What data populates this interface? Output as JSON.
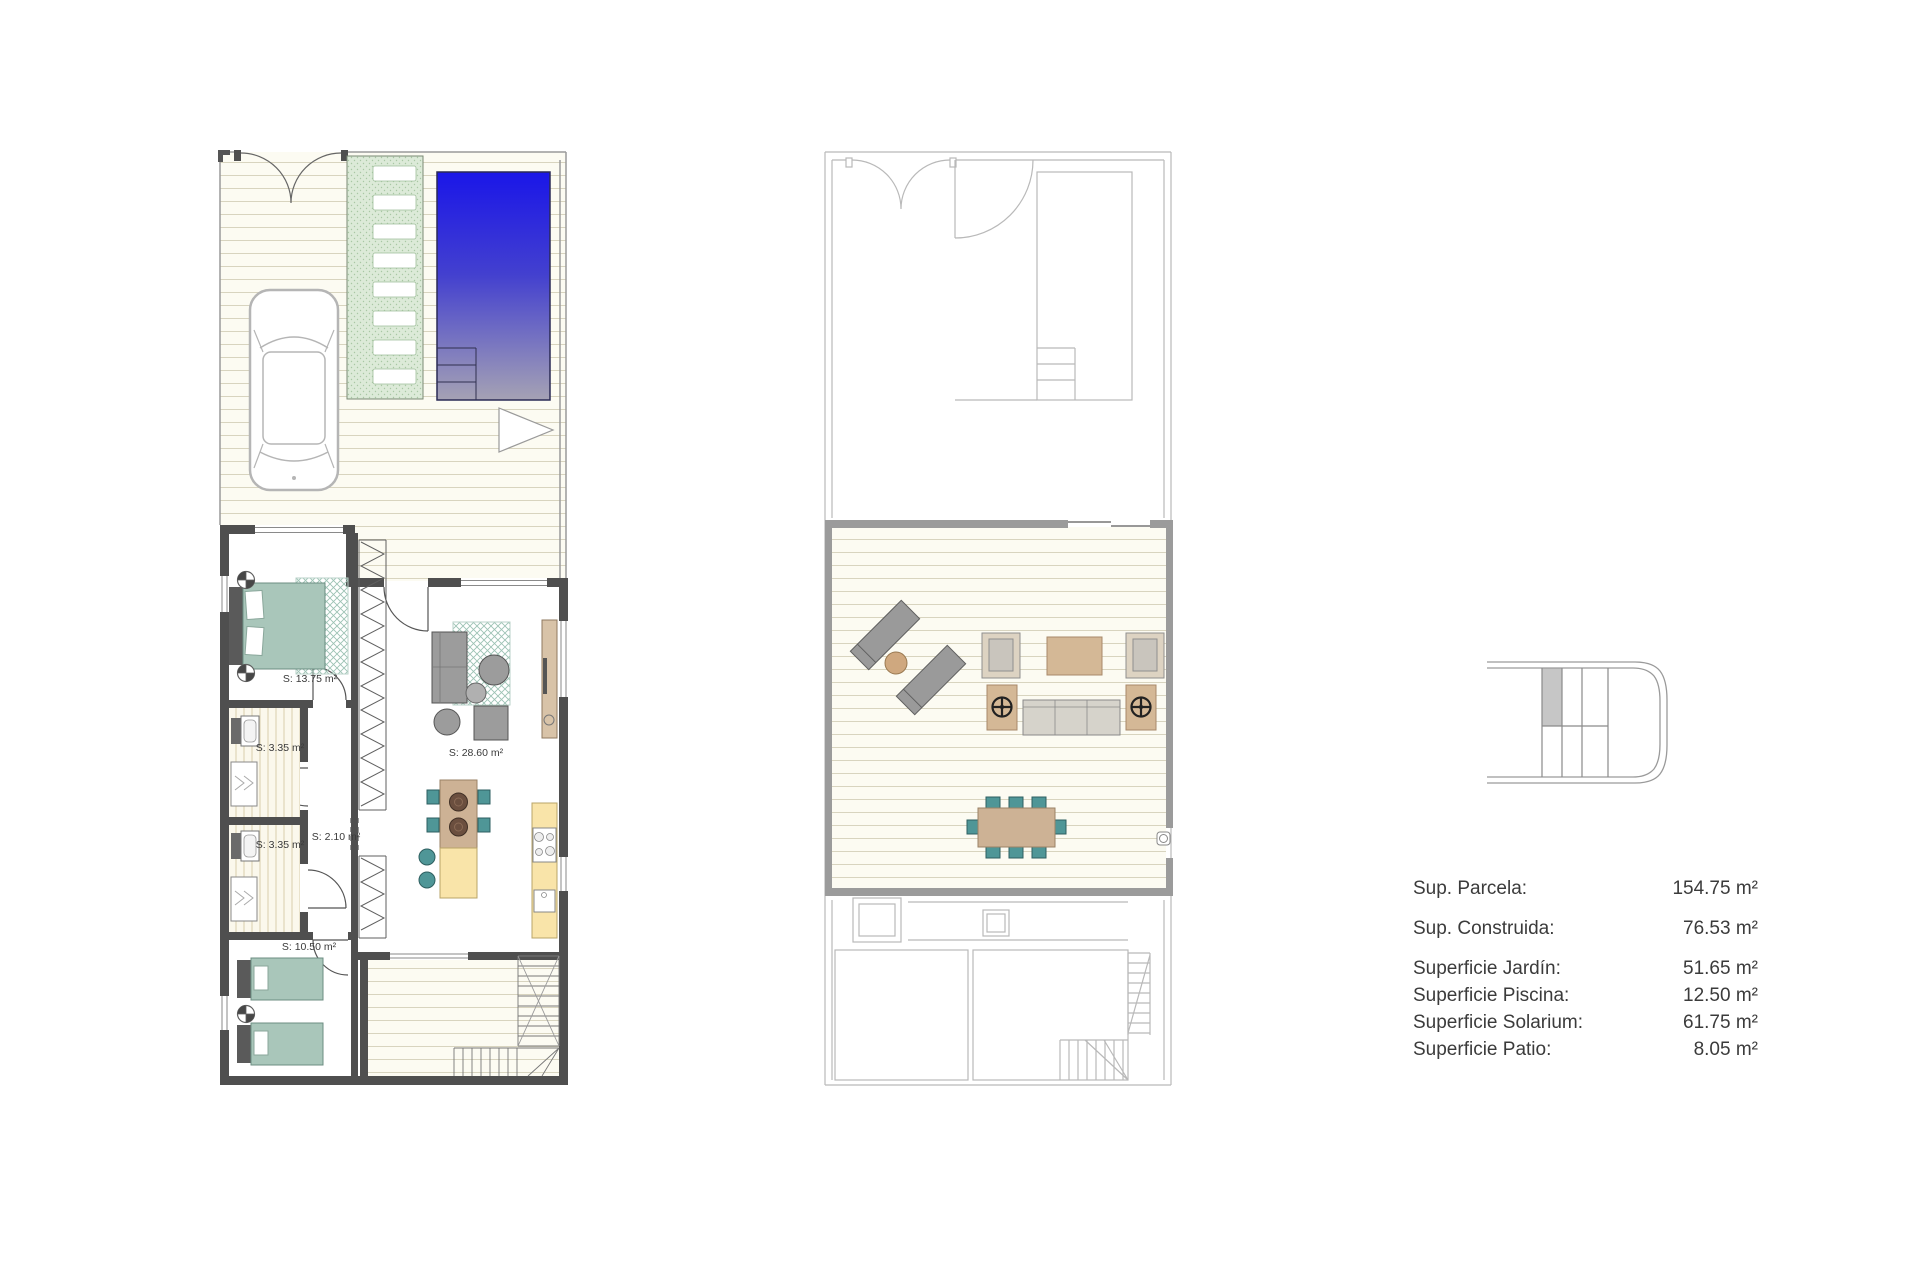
{
  "colors": {
    "pool_top": "#1a16e8",
    "pool_bottom": "#a5a2b4",
    "garden_path_green": "#dcead8",
    "deck_cream": "#fcfbf2",
    "wall_dark": "#4f4f4f",
    "underfloor_gray": "#b9b9b9",
    "bed_teal": "#a9c6ba",
    "chair_teal": "#4f9697",
    "wood_tan": "#cdb295",
    "counter_yellow": "#f9e4a9",
    "sofa_gray": "#9c9c9c",
    "key_plan_shaded_unit": "#c6c6c6"
  },
  "icons": {
    "ceiling_light": "circle-with-cross-quadrants",
    "parasol_base": "dark-circle-with-spokes",
    "stove": "four-burner-hob",
    "sink": "square-basin",
    "shower": "tray-with-chevrons",
    "gate": "double-leaf-arc",
    "stairs": "ladder-with-cross"
  },
  "ground_floor": {
    "rooms": [
      {
        "name": "bedroom-1",
        "label": "S: 13.75 m²"
      },
      {
        "name": "bathroom-1",
        "label": "S: 3.35 m²"
      },
      {
        "name": "hall",
        "label": "S: 2.10 m²"
      },
      {
        "name": "bathroom-2",
        "label": "S: 3.35 m²"
      },
      {
        "name": "living-kitchen",
        "label": "S: 28.60 m²"
      },
      {
        "name": "bedroom-2",
        "label": "S: 10.50 m²"
      }
    ]
  },
  "legend": {
    "rows": [
      {
        "label": "Sup. Parcela:",
        "value": "154.75 m²"
      },
      {
        "label": "Sup. Construida:",
        "value": "76.53 m²"
      },
      {
        "label": "Superficie Jardín:",
        "value": "51.65 m²"
      },
      {
        "label": "Superficie Piscina:",
        "value": "12.50 m²"
      },
      {
        "label": "Superficie Solarium:",
        "value": "61.75 m²"
      },
      {
        "label": "Superficie Patio:",
        "value": "8.05 m²"
      }
    ]
  },
  "key_plan": {
    "shaded_unit_color": "#c6c6c6"
  }
}
